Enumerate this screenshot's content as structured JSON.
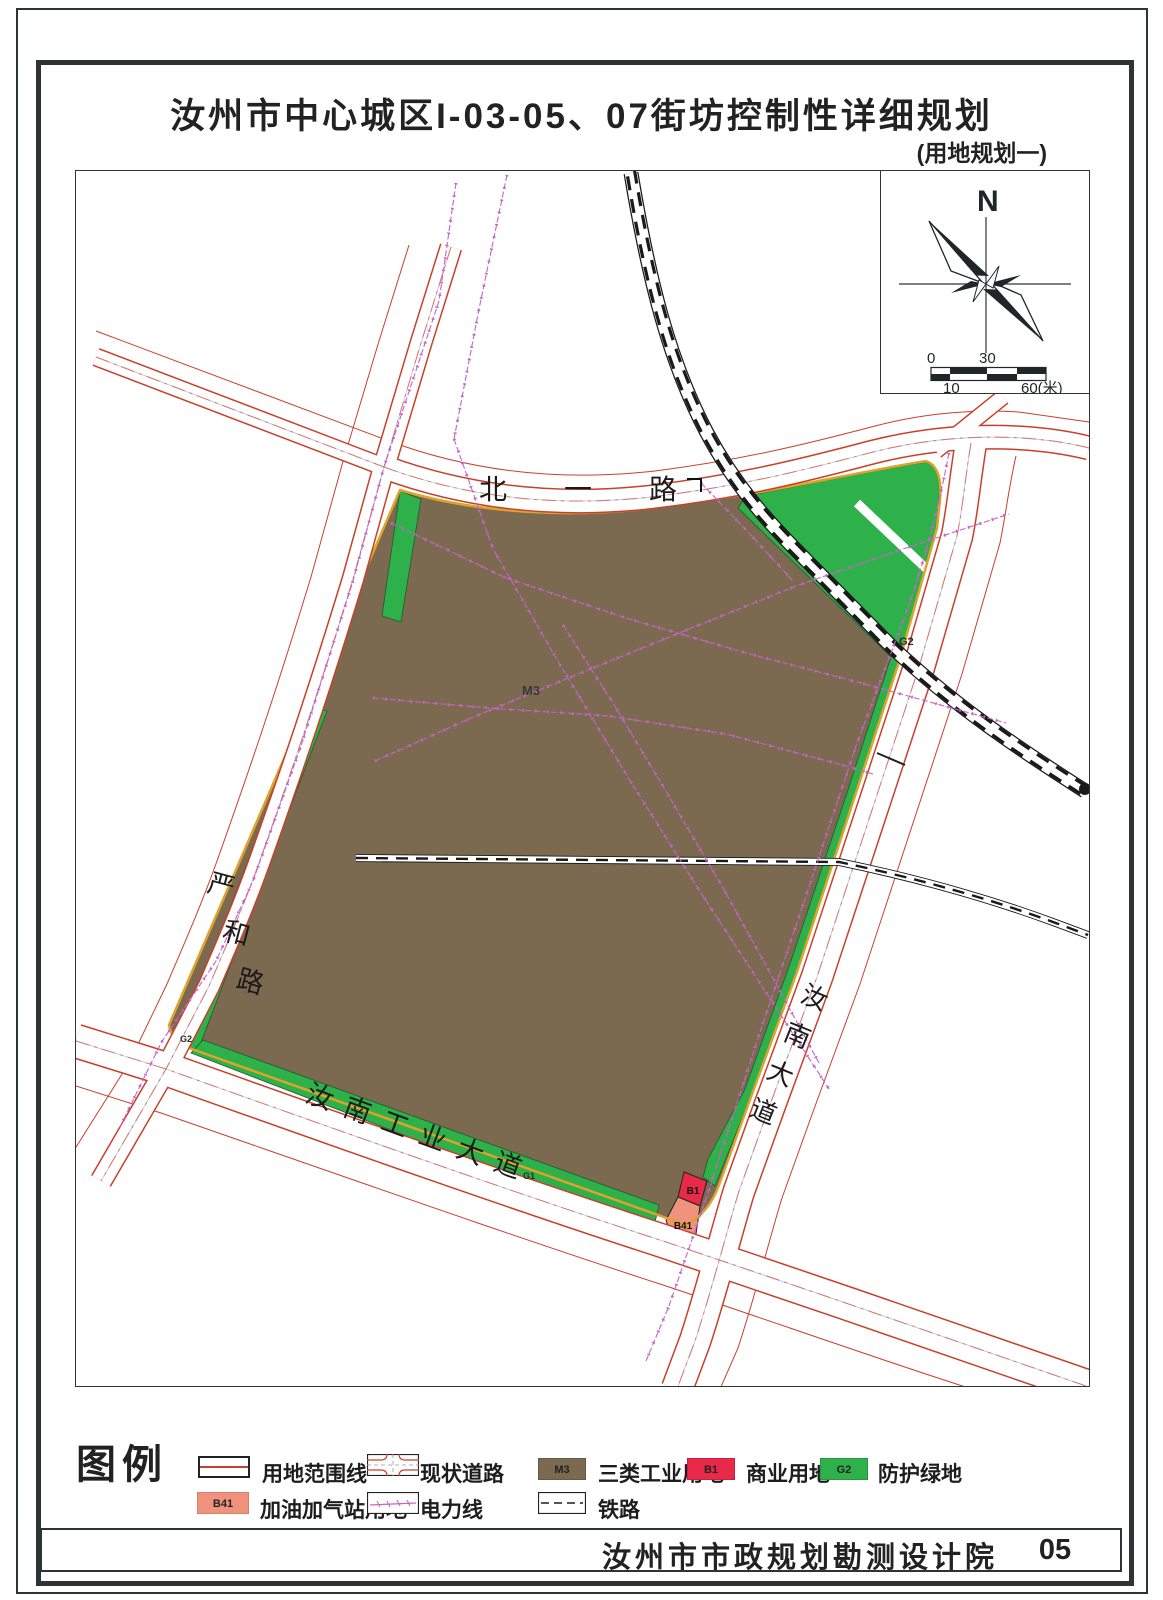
{
  "page": {
    "title": "汝州市中心城区I-03-05、07街坊控制性详细规划",
    "subtitle": "(用地规划一)",
    "footer": {
      "institute": "汝州市市政规划勘测设计院",
      "page_number": "05"
    }
  },
  "compass": {
    "north_label": "N"
  },
  "scale_bar": {
    "zero": "0",
    "thirty": "30",
    "ten": "10",
    "sixty": "60(米)"
  },
  "map": {
    "roads": {
      "beiyilu": {
        "name": "北一路"
      },
      "yanhe": {
        "name": "严和路",
        "chars": [
          "严",
          "和",
          "路"
        ]
      },
      "gongye": {
        "name": "汝南工业大道"
      },
      "runandadao": {
        "name": "汝南大道",
        "chars": [
          "汝",
          "南",
          "大",
          "道"
        ]
      }
    },
    "zones": [
      {
        "code": "M3"
      },
      {
        "code": "G2"
      },
      {
        "code": "G2"
      },
      {
        "code": "G1"
      },
      {
        "code": "B1"
      },
      {
        "code": "B41"
      }
    ]
  },
  "legend": {
    "title": "图例",
    "items": [
      {
        "label": "用地范围线"
      },
      {
        "label": "现状道路"
      },
      {
        "code": "M3",
        "label": "三类工业用地"
      },
      {
        "code": "B1",
        "label": "商业用地"
      },
      {
        "code": "G2",
        "label": "防护绿地"
      },
      {
        "code": "B41",
        "label": "加油加气站用地"
      },
      {
        "label": "电力线"
      },
      {
        "label": "铁路"
      }
    ]
  },
  "colors": {
    "m3": "#7b6a50",
    "b1": "#e8294a",
    "g2": "#2eb04a",
    "b41": "#f0937c",
    "road_edge": "#c8402c",
    "boundary": "#dda32b",
    "power_line": "#c564c5",
    "railway": "#1a1a1a",
    "frame": "#2e3333"
  }
}
